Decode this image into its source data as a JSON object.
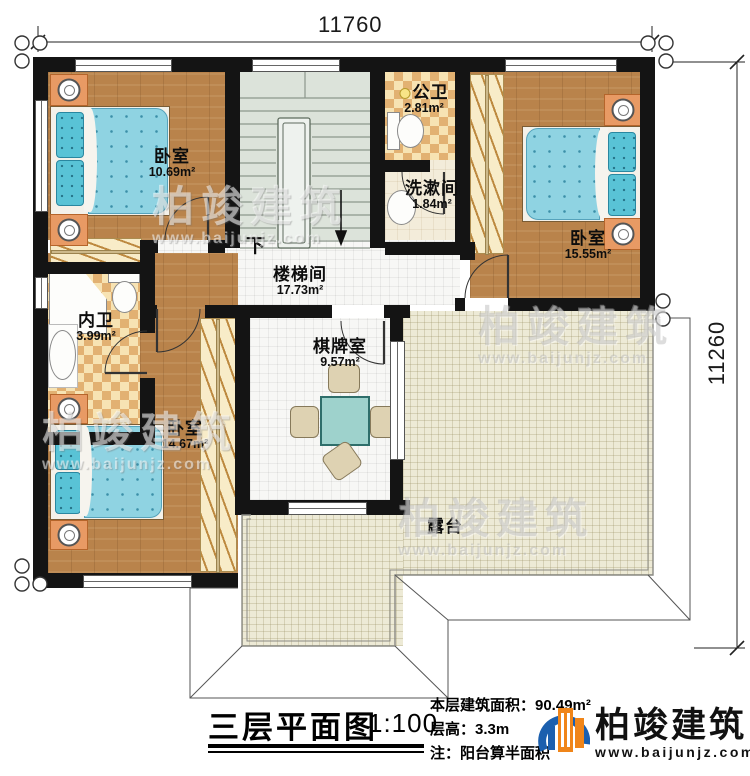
{
  "dimensions": {
    "top": "11760",
    "right": "11260"
  },
  "rooms": {
    "bedroom_tl": {
      "name": "卧室",
      "area": "10.69m²"
    },
    "public_bath": {
      "name": "公卫",
      "area": "2.81m²"
    },
    "washroom": {
      "name": "洗漱间",
      "area": "1.84m²"
    },
    "bedroom_tr": {
      "name": "卧室",
      "area": "15.55m²"
    },
    "stairwell": {
      "name": "楼梯间",
      "area": "17.73m²"
    },
    "inner_bath": {
      "name": "内卫",
      "area": "3.99m²"
    },
    "bedroom_bl": {
      "name": "卧室",
      "area": "14.67m²"
    },
    "game_room": {
      "name": "棋牌室",
      "area": "9.57m²"
    },
    "terrace": {
      "name": "露台"
    }
  },
  "stair": {
    "down_label": "下"
  },
  "title_block": {
    "plan_title": "三层平面图",
    "scale": "1:100",
    "area_line": "本层建筑面积：90.49m²",
    "height_line": "层高：3.3m",
    "note_line": "注：阳台算半面积",
    "brand": "柏竣建筑",
    "brand_url": "www.baijunjz.com"
  },
  "watermark": {
    "brand": "柏竣建筑",
    "url": "www.baijunjz.com"
  },
  "colors": {
    "wall": "#141414",
    "wood": "#b9834b",
    "bed": "#8fd3e2",
    "terrace": "#edead6",
    "logo_blue": "#1b5fae",
    "logo_orange": "#f08519"
  }
}
